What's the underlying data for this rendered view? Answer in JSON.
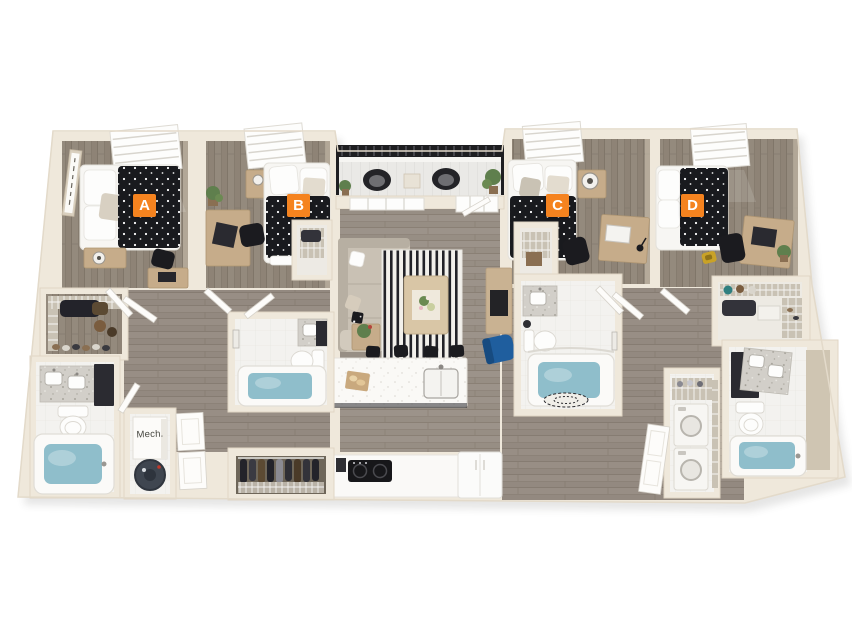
{
  "floor_plan": {
    "badges": [
      {
        "label": "A"
      },
      {
        "label": "B"
      },
      {
        "label": "C"
      },
      {
        "label": "D"
      }
    ],
    "room_labels": {
      "mechanical_closet": "Mech."
    },
    "colors": {
      "accent": "#F5831F",
      "badge_text": "#FFFFFF",
      "wall": "#EFE8DB",
      "wall_face": "#CFC5B2",
      "wood_floor": "#8E8478",
      "bathroom_tile": "#F3F2EF",
      "bathtub_water": "#8FBECB",
      "bedding": "#191A1E",
      "railing": "#1E1E21",
      "desk_wood": "#C6AC8A",
      "chair_blue": "#1F5E9E",
      "background": "#FFFFFF"
    }
  }
}
